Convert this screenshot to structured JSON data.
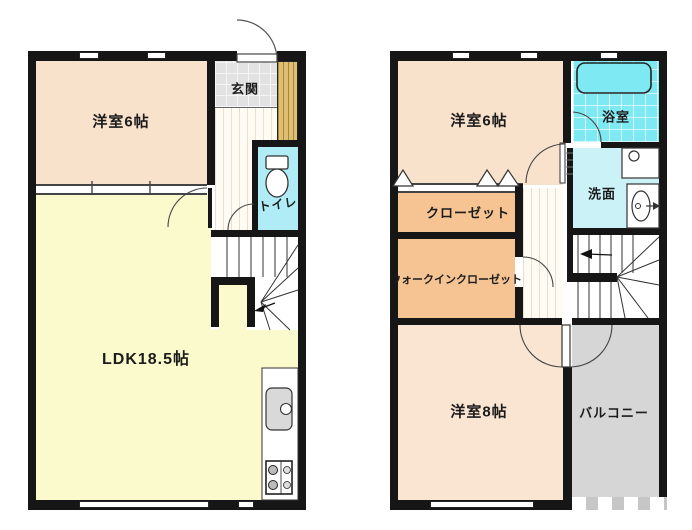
{
  "floor1": {
    "rooms": {
      "western6": "洋室6帖",
      "genkan": "玄関",
      "toilet": "トイレ",
      "ldk": "LDK18.5帖"
    }
  },
  "floor2": {
    "rooms": {
      "western6": "洋室6帖",
      "bath": "浴室",
      "washroom": "洗面",
      "closet": "クローゼット",
      "wic": "ウォークインクローゼット",
      "western8": "洋室8帖",
      "balcony": "バルコニー"
    }
  },
  "colors": {
    "wall": "#161616",
    "western_room_1f": "#F9E2CB",
    "western_room_2f": "#FAE5D3",
    "ldk": "#FBFACC",
    "closet": "#F6C493",
    "bath": "#7EE9F2",
    "washroom": "#CBF2F7",
    "toilet": "#AFECF5",
    "genkan_tile": "#E2E2E2",
    "wood_cabinet": "#DDBE74",
    "balcony": "#D6D6D6"
  }
}
